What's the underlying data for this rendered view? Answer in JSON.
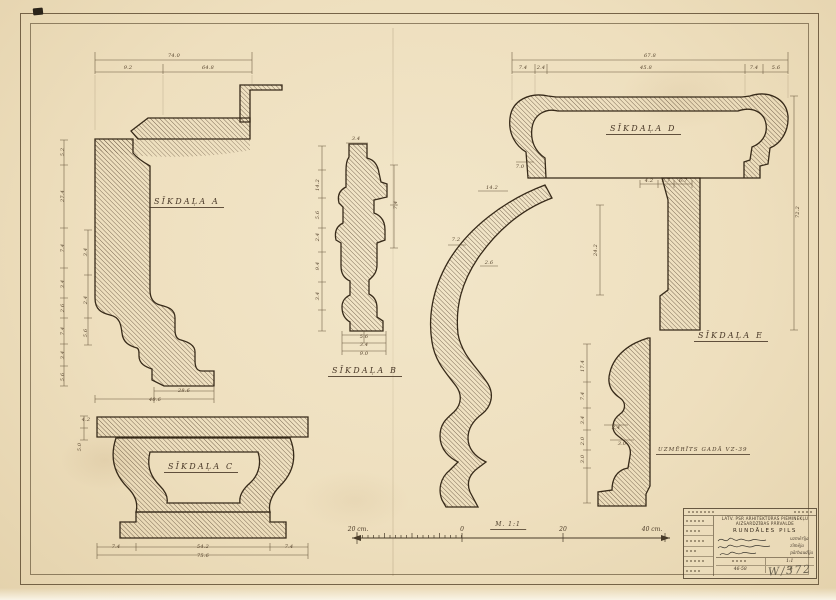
{
  "colors": {
    "paper": "#eedfbe",
    "ink": "#372a19",
    "dim_ink": "#54422c",
    "border": "#604e32"
  },
  "details": {
    "a": {
      "label": "SĪKDAĻA A"
    },
    "b": {
      "label": "SĪKDAĻA B"
    },
    "c": {
      "label": "SĪKDAĻA C"
    },
    "d": {
      "label": "SĪKDAĻA D"
    },
    "e": {
      "label": "SĪKDAĻA E"
    }
  },
  "note": {
    "text": "UZMĒRĪTS GADĀ VZ-39"
  },
  "scale_bar": {
    "left_label": "20 cm.",
    "zero_label": "0",
    "mid_label": "20",
    "right_label": "40 cm.",
    "caption": "M. 1:1"
  },
  "title_block": {
    "org_line1": "LATV. PSR ARHITEKTŪRAS PIEMINEKĻU",
    "org_line2": "AIZSARDZĪBAS PĀRVALDE",
    "object": "RUNDĀLES PILS",
    "roles": [
      "uzmērīja",
      "zīmēja",
      "pārbaudīja"
    ],
    "scale_value": "1:1",
    "doc_number": "46-58",
    "year": "56"
  },
  "inventory_number": "W/372",
  "dim_labels": [
    {
      "t": "74.0",
      "x": 174,
      "y": 56
    },
    {
      "t": "9.2",
      "x": 128,
      "y": 68
    },
    {
      "t": "64.8",
      "x": 208,
      "y": 68
    },
    {
      "t": "5.2",
      "x": 63,
      "y": 152,
      "r": -90
    },
    {
      "t": "27.4",
      "x": 63,
      "y": 196,
      "r": -90
    },
    {
      "t": "7.4",
      "x": 63,
      "y": 248,
      "r": -90
    },
    {
      "t": "3.4",
      "x": 63,
      "y": 284,
      "r": -90
    },
    {
      "t": "2.6",
      "x": 63,
      "y": 308,
      "r": -90
    },
    {
      "t": "7.4",
      "x": 63,
      "y": 331,
      "r": -90
    },
    {
      "t": "3.4",
      "x": 63,
      "y": 355,
      "r": -90
    },
    {
      "t": "5.6",
      "x": 63,
      "y": 377,
      "r": -90
    },
    {
      "t": "3.4",
      "x": 86,
      "y": 252,
      "r": -90
    },
    {
      "t": "2.4",
      "x": 86,
      "y": 300,
      "r": -90
    },
    {
      "t": "5.6",
      "x": 86,
      "y": 333,
      "r": -90
    },
    {
      "t": "28.6",
      "x": 184,
      "y": 391
    },
    {
      "t": "40.6",
      "x": 155,
      "y": 400
    },
    {
      "t": "14.2",
      "x": 318,
      "y": 185,
      "r": -90
    },
    {
      "t": "5.6",
      "x": 318,
      "y": 215,
      "r": -90
    },
    {
      "t": "2.4",
      "x": 318,
      "y": 237,
      "r": -90
    },
    {
      "t": "9.4",
      "x": 318,
      "y": 266,
      "r": -90
    },
    {
      "t": "3.4",
      "x": 318,
      "y": 296,
      "r": -90
    },
    {
      "t": "7.4",
      "x": 396,
      "y": 205,
      "r": -90
    },
    {
      "t": "3.4",
      "x": 356,
      "y": 139
    },
    {
      "t": "5.6",
      "x": 364,
      "y": 337
    },
    {
      "t": "3.4",
      "x": 364,
      "y": 345
    },
    {
      "t": "9.0",
      "x": 364,
      "y": 354
    },
    {
      "t": "4.2",
      "x": 86,
      "y": 420
    },
    {
      "t": "5.0",
      "x": 80,
      "y": 447,
      "r": -90
    },
    {
      "t": "7.4",
      "x": 116,
      "y": 547
    },
    {
      "t": "54.2",
      "x": 203,
      "y": 547
    },
    {
      "t": "7.4",
      "x": 289,
      "y": 547
    },
    {
      "t": "75.6",
      "x": 203,
      "y": 556
    },
    {
      "t": "67.8",
      "x": 650,
      "y": 56
    },
    {
      "t": "7.4",
      "x": 523,
      "y": 68
    },
    {
      "t": "2.4",
      "x": 541,
      "y": 68
    },
    {
      "t": "45.8",
      "x": 646,
      "y": 68
    },
    {
      "t": "7.4",
      "x": 754,
      "y": 68
    },
    {
      "t": "5.6",
      "x": 776,
      "y": 68
    },
    {
      "t": "72.2",
      "x": 798,
      "y": 212,
      "r": -90
    },
    {
      "t": "4.2",
      "x": 649,
      "y": 181
    },
    {
      "t": "2.7",
      "x": 666,
      "y": 181
    },
    {
      "t": "6.7",
      "x": 683,
      "y": 181
    },
    {
      "t": "7.0",
      "x": 520,
      "y": 167
    },
    {
      "t": "14.2",
      "x": 492,
      "y": 188
    },
    {
      "t": "7.2",
      "x": 456,
      "y": 240
    },
    {
      "t": "2.6",
      "x": 489,
      "y": 263
    },
    {
      "t": "24.2",
      "x": 596,
      "y": 250,
      "r": -90
    },
    {
      "t": "17.4",
      "x": 583,
      "y": 366,
      "r": -90
    },
    {
      "t": "7.4",
      "x": 583,
      "y": 396,
      "r": -90
    },
    {
      "t": "3.4",
      "x": 583,
      "y": 420,
      "r": -90
    },
    {
      "t": "2.0",
      "x": 583,
      "y": 441,
      "r": -90
    },
    {
      "t": "3.0",
      "x": 583,
      "y": 459,
      "r": -90
    },
    {
      "t": "2.4",
      "x": 616,
      "y": 428
    },
    {
      "t": "3.0",
      "x": 622,
      "y": 444
    }
  ]
}
